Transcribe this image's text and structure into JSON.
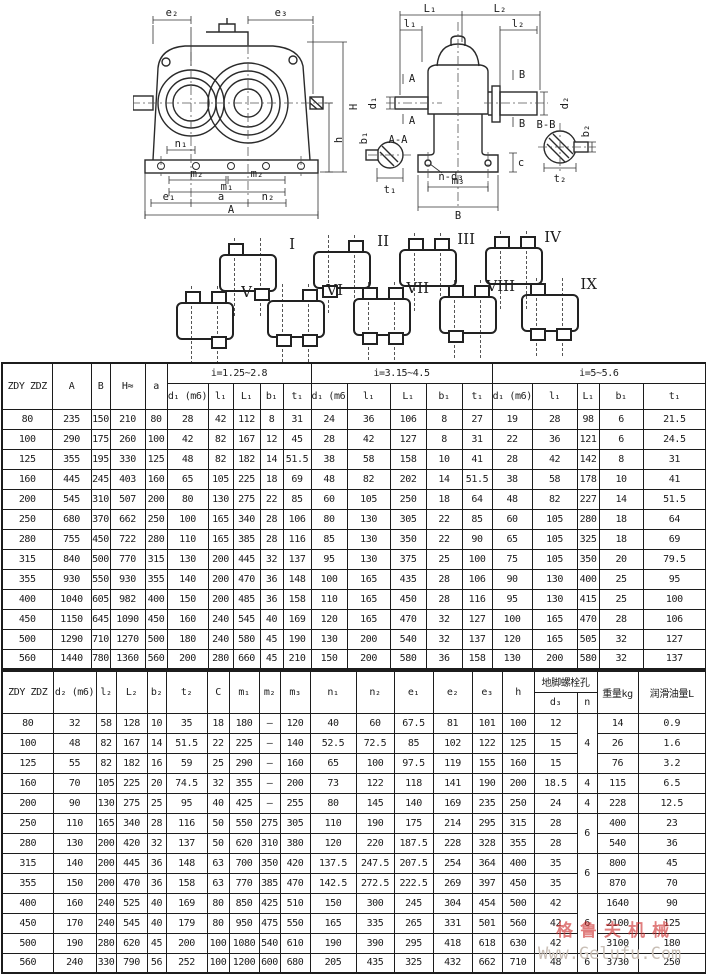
{
  "watermark": {
    "cn": "格鲁夫机械",
    "url": "Www.Gelufu.Com",
    "cn_color": "#cd2d2d",
    "url_color": "#c9bfb6"
  },
  "drawings": {
    "front": {
      "labels": {
        "e2": "e₂",
        "e3": "e₃",
        "H": "H",
        "h": "h",
        "n1": "n₁",
        "m2_left": "m₂",
        "m2_right": "m₂",
        "m1": "m₁",
        "e1": "e₁",
        "a": "a",
        "n2": "n₂",
        "A": "A"
      }
    },
    "side": {
      "labels": {
        "L1": "L₁",
        "L2": "L₂",
        "l1": "l₁",
        "l2": "l₂",
        "d1": "d₁",
        "d2": "d₂",
        "secA_top": "A",
        "secA_bottom": "A",
        "secB_top": "B",
        "secB_bottom": "B",
        "AA": "A-A",
        "BB": "B-B",
        "b1": "b₁",
        "t1": "t₁",
        "b2": "b₂",
        "t2": "t₂",
        "c": "c",
        "n_d3": "n-d₃",
        "m3": "m₃",
        "B": "B"
      }
    }
  },
  "assembly_forms": [
    {
      "label": "I",
      "top": [
        "l"
      ],
      "bottom": [
        "r"
      ]
    },
    {
      "label": "II",
      "top": [
        "r"
      ],
      "bottom": [
        "l"
      ]
    },
    {
      "label": "III",
      "top": [
        "l",
        "r"
      ],
      "bottom": []
    },
    {
      "label": "IV",
      "top": [
        "l",
        "r"
      ],
      "bottom": []
    },
    {
      "label": "V",
      "top": [
        "l",
        "r"
      ],
      "bottom": [
        "r"
      ]
    },
    {
      "label": "VI",
      "top": [
        "r"
      ],
      "bottom": [
        "l",
        "r"
      ]
    },
    {
      "label": "VII",
      "top": [
        "l",
        "r"
      ],
      "bottom": [
        "l",
        "r"
      ]
    },
    {
      "label": "VIII",
      "top": [
        "l",
        "r"
      ],
      "bottom": [
        "l"
      ]
    },
    {
      "label": "IX",
      "top": [
        "l"
      ],
      "bottom": [
        "l",
        "r"
      ]
    }
  ],
  "table1": {
    "row_header": "ZDY ZDZ",
    "fixed_headers": [
      "A",
      "B",
      "H≈",
      "a"
    ],
    "groups": [
      "i=1.25~2.8",
      "i=3.15~4.5",
      "i=5~5.6"
    ],
    "sub_headers": [
      "d₁ (m6)",
      "l₁",
      "L₁",
      "b₁",
      "t₁"
    ],
    "rows": [
      [
        "80",
        "235",
        "150",
        "210",
        "80",
        "28",
        "42",
        "112",
        "8",
        "31",
        "24",
        "36",
        "106",
        "8",
        "27",
        "19",
        "28",
        "98",
        "6",
        "21.5"
      ],
      [
        "100",
        "290",
        "175",
        "260",
        "100",
        "42",
        "82",
        "167",
        "12",
        "45",
        "28",
        "42",
        "127",
        "8",
        "31",
        "22",
        "36",
        "121",
        "6",
        "24.5"
      ],
      [
        "125",
        "355",
        "195",
        "330",
        "125",
        "48",
        "82",
        "182",
        "14",
        "51.5",
        "38",
        "58",
        "158",
        "10",
        "41",
        "28",
        "42",
        "142",
        "8",
        "31"
      ],
      [
        "160",
        "445",
        "245",
        "403",
        "160",
        "65",
        "105",
        "225",
        "18",
        "69",
        "48",
        "82",
        "202",
        "14",
        "51.5",
        "38",
        "58",
        "178",
        "10",
        "41"
      ],
      [
        "200",
        "545",
        "310",
        "507",
        "200",
        "80",
        "130",
        "275",
        "22",
        "85",
        "60",
        "105",
        "250",
        "18",
        "64",
        "48",
        "82",
        "227",
        "14",
        "51.5"
      ],
      [
        "250",
        "680",
        "370",
        "662",
        "250",
        "100",
        "165",
        "340",
        "28",
        "106",
        "80",
        "130",
        "305",
        "22",
        "85",
        "60",
        "105",
        "280",
        "18",
        "64"
      ],
      [
        "280",
        "755",
        "450",
        "722",
        "280",
        "110",
        "165",
        "385",
        "28",
        "116",
        "85",
        "130",
        "350",
        "22",
        "90",
        "65",
        "105",
        "325",
        "18",
        "69"
      ],
      [
        "315",
        "840",
        "500",
        "770",
        "315",
        "130",
        "200",
        "445",
        "32",
        "137",
        "95",
        "130",
        "375",
        "25",
        "100",
        "75",
        "105",
        "350",
        "20",
        "79.5"
      ],
      [
        "355",
        "930",
        "550",
        "930",
        "355",
        "140",
        "200",
        "470",
        "36",
        "148",
        "100",
        "165",
        "435",
        "28",
        "106",
        "90",
        "130",
        "400",
        "25",
        "95"
      ],
      [
        "400",
        "1040",
        "605",
        "982",
        "400",
        "150",
        "200",
        "485",
        "36",
        "158",
        "110",
        "165",
        "450",
        "28",
        "116",
        "95",
        "130",
        "415",
        "25",
        "100"
      ],
      [
        "450",
        "1150",
        "645",
        "1090",
        "450",
        "160",
        "240",
        "545",
        "40",
        "169",
        "120",
        "165",
        "470",
        "32",
        "127",
        "100",
        "165",
        "470",
        "28",
        "106"
      ],
      [
        "500",
        "1290",
        "710",
        "1270",
        "500",
        "180",
        "240",
        "580",
        "45",
        "190",
        "130",
        "200",
        "540",
        "32",
        "137",
        "120",
        "165",
        "505",
        "32",
        "127"
      ],
      [
        "560",
        "1440",
        "780",
        "1360",
        "560",
        "200",
        "280",
        "660",
        "45",
        "210",
        "150",
        "200",
        "580",
        "36",
        "158",
        "130",
        "200",
        "580",
        "32",
        "137"
      ]
    ]
  },
  "table2": {
    "row_header": "ZDY ZDZ",
    "headers": [
      "d₂ (m6)",
      "l₂",
      "L₂",
      "b₂",
      "t₂",
      "C",
      "m₁",
      "m₂",
      "m₃",
      "n₁",
      "n₂",
      "e₁",
      "e₂",
      "e₃",
      "h"
    ],
    "bolt_hole_group": "地脚螺栓孔",
    "bolt_sub": [
      "d₃",
      "n"
    ],
    "weight": "重量kg",
    "oil": "润滑油量L",
    "rows": [
      [
        "80",
        "32",
        "58",
        "128",
        "10",
        "35",
        "18",
        "180",
        "—",
        "120",
        "40",
        "60",
        "67.5",
        "81",
        "101",
        "100",
        "12",
        {
          "v": "4",
          "rs": 3
        },
        "14",
        "0.9"
      ],
      [
        "100",
        "48",
        "82",
        "167",
        "14",
        "51.5",
        "22",
        "225",
        "—",
        "140",
        "52.5",
        "72.5",
        "85",
        "102",
        "122",
        "125",
        "15",
        "26",
        "1.6"
      ],
      [
        "125",
        "55",
        "82",
        "182",
        "16",
        "59",
        "25",
        "290",
        "—",
        "160",
        "65",
        "100",
        "97.5",
        "119",
        "155",
        "160",
        "15",
        "76",
        "3.2"
      ],
      [
        "160",
        "70",
        "105",
        "225",
        "20",
        "74.5",
        "32",
        "355",
        "—",
        "200",
        "73",
        "122",
        "118",
        "141",
        "190",
        "200",
        "18.5",
        "4",
        "115",
        "6.5"
      ],
      [
        "200",
        "90",
        "130",
        "275",
        "25",
        "95",
        "40",
        "425",
        "—",
        "255",
        "80",
        "145",
        "140",
        "169",
        "235",
        "250",
        "24",
        "4",
        "228",
        "12.5"
      ],
      [
        "250",
        "110",
        "165",
        "340",
        "28",
        "116",
        "50",
        "550",
        "275",
        "305",
        "110",
        "190",
        "175",
        "214",
        "295",
        "315",
        "28",
        {
          "v": "6",
          "rs": 2
        },
        "400",
        "23"
      ],
      [
        "280",
        "130",
        "200",
        "420",
        "32",
        "137",
        "50",
        "620",
        "310",
        "380",
        "120",
        "220",
        "187.5",
        "228",
        "328",
        "355",
        "28",
        "540",
        "36"
      ],
      [
        "315",
        "140",
        "200",
        "445",
        "36",
        "148",
        "63",
        "700",
        "350",
        "420",
        "137.5",
        "247.5",
        "207.5",
        "254",
        "364",
        "400",
        "35",
        {
          "v": "6",
          "rs": 2
        },
        "800",
        "45"
      ],
      [
        "355",
        "150",
        "200",
        "470",
        "36",
        "158",
        "63",
        "770",
        "385",
        "470",
        "142.5",
        "272.5",
        "222.5",
        "269",
        "397",
        "450",
        "35",
        "870",
        "70"
      ],
      [
        "400",
        "160",
        "240",
        "525",
        "40",
        "169",
        "80",
        "850",
        "425",
        "510",
        "150",
        "300",
        "245",
        "304",
        "454",
        "500",
        "42",
        {
          "v": "6",
          "rs": 3
        },
        "1640",
        "90"
      ],
      [
        "450",
        "170",
        "240",
        "545",
        "40",
        "179",
        "80",
        "950",
        "475",
        "550",
        "165",
        "335",
        "265",
        "331",
        "501",
        "560",
        "42",
        "2100",
        "125"
      ],
      [
        "500",
        "190",
        "280",
        "620",
        "45",
        "200",
        "100",
        "1080",
        "540",
        "610",
        "190",
        "390",
        "295",
        "418",
        "618",
        "630",
        "42",
        "3100",
        "180"
      ],
      [
        "560",
        "240",
        "330",
        "790",
        "56",
        "252",
        "100",
        "1200",
        "600",
        "680",
        "205",
        "435",
        "325",
        "432",
        "662",
        "710",
        "48",
        "6",
        "3730",
        "250"
      ]
    ]
  }
}
